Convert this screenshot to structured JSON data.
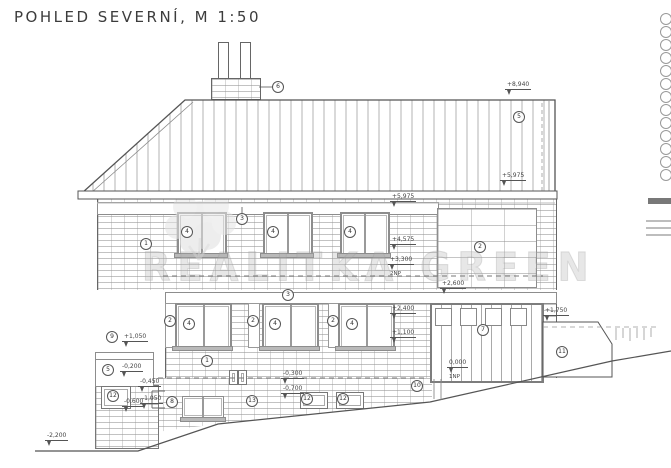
{
  "title": "POHLED SEVERNÍ, M 1:50",
  "watermark": "REALITKA GREEN",
  "elevations": {
    "ridge": "+8,940",
    "eaves": "+5,975",
    "col_top": "+5,975",
    "col_mid": "+4,575",
    "floor2": "+3,300",
    "floor2_label": "2NP",
    "garage_head": "+2,600",
    "win_head": "+2,400",
    "win_sill": "+1,100",
    "rwall_top": "+1,750",
    "zero": "0,000",
    "zero_label": "1NP",
    "lwall_top": "+1,050",
    "lwall_mid": "-0,200",
    "lwall_low": "-0,600",
    "step_top": "-0,450",
    "step_bot": "-1,050",
    "base_line": "-0,300",
    "base_low": "-0,700",
    "ground_left": "-2,200"
  },
  "callouts": {
    "roof": "5",
    "chimney": "6",
    "wall_upper": "1",
    "wall_lower": "1",
    "band_upper": "3",
    "band_lower": "3",
    "block": "2",
    "pilaster_1": "2",
    "pilaster_2": "2",
    "pilaster_3": "2",
    "window_u1": "4",
    "window_u2": "4",
    "window_u3": "4",
    "window_l1": "4",
    "window_l2": "4",
    "window_l3": "4",
    "garage": "7",
    "lwall_top": "9",
    "lwall_face": "5",
    "lwall_vent": "12",
    "basement_win": "8",
    "basement_wall": "13",
    "vent_a": "12",
    "vent_b": "12",
    "slope": "10",
    "rwall": "11"
  }
}
